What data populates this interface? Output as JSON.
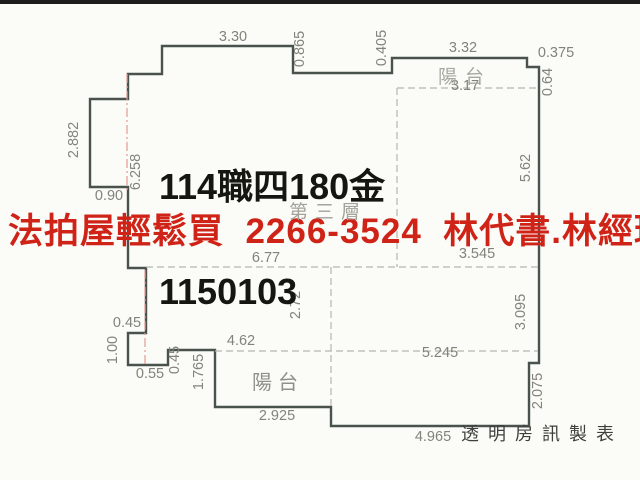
{
  "title": {
    "line1": "114職四180金",
    "line2": "1150103"
  },
  "banner": {
    "text": "法拍屋輕鬆買  2266-3524  林代書.林經理",
    "color": "#cf2318"
  },
  "labels": {
    "floor": "第三層",
    "balcony_top": "陽台",
    "balcony_bottom": "陽台",
    "credit": "透明房訊製表"
  },
  "plan": {
    "wall_color": "#4a524e",
    "dash_color": "#b7b7af",
    "centerline_color": "#e59a93",
    "dim_color": "#83837c",
    "outline_points": "162,46 293,46 293,73 392,73 392,58 527,58 527,67 539,67 539,363 529,363 529,426 331,426 331,407 215,407 215,350 168,350 168,365 128,365 128,333 146,333 146,268 128,268 128,187 90,187 90,99 128,99 128,74 162,74",
    "dashed_lines": [
      {
        "x1": 397,
        "y1": 88,
        "x2": 538,
        "y2": 88
      },
      {
        "x1": 397,
        "y1": 88,
        "x2": 397,
        "y2": 267
      },
      {
        "x1": 146,
        "y1": 267,
        "x2": 538,
        "y2": 267
      },
      {
        "x1": 331,
        "y1": 267,
        "x2": 331,
        "y2": 407
      },
      {
        "x1": 215,
        "y1": 351,
        "x2": 538,
        "y2": 351
      }
    ],
    "centerlines": [
      {
        "x1": 127,
        "y1": 74,
        "x2": 127,
        "y2": 190
      },
      {
        "x1": 145,
        "y1": 270,
        "x2": 145,
        "y2": 364
      }
    ],
    "dim_labels_h": [
      {
        "text": "3.30",
        "x": 233,
        "y": 41
      },
      {
        "text": "3.32",
        "x": 463,
        "y": 52
      },
      {
        "text": "0.375",
        "x": 556,
        "y": 57
      },
      {
        "text": "3.17",
        "x": 465,
        "y": 90
      },
      {
        "text": "0.90",
        "x": 109,
        "y": 200
      },
      {
        "text": "6.77",
        "x": 266,
        "y": 262
      },
      {
        "text": "3.545",
        "x": 477,
        "y": 258
      },
      {
        "text": "0.45",
        "x": 127,
        "y": 327
      },
      {
        "text": "4.62",
        "x": 241,
        "y": 345
      },
      {
        "text": "5.245",
        "x": 440,
        "y": 357
      },
      {
        "text": "0.55",
        "x": 150,
        "y": 378
      },
      {
        "text": "2.925",
        "x": 277,
        "y": 420
      },
      {
        "text": "4.965",
        "x": 433,
        "y": 441
      }
    ],
    "dim_labels_v": [
      {
        "text": "0.865",
        "x": 304,
        "y": 49
      },
      {
        "text": "0.405",
        "x": 386,
        "y": 48
      },
      {
        "text": "0.64",
        "x": 552,
        "y": 82
      },
      {
        "text": "2.882",
        "x": 78,
        "y": 140
      },
      {
        "text": "6.258",
        "x": 140,
        "y": 172
      },
      {
        "text": "5.62",
        "x": 530,
        "y": 168
      },
      {
        "text": "2.72",
        "x": 300,
        "y": 305
      },
      {
        "text": "3.095",
        "x": 525,
        "y": 312
      },
      {
        "text": "1.00",
        "x": 117,
        "y": 350
      },
      {
        "text": "0.45",
        "x": 179,
        "y": 360
      },
      {
        "text": "1.765",
        "x": 203,
        "y": 372
      },
      {
        "text": "2.075",
        "x": 542,
        "y": 391
      }
    ]
  }
}
